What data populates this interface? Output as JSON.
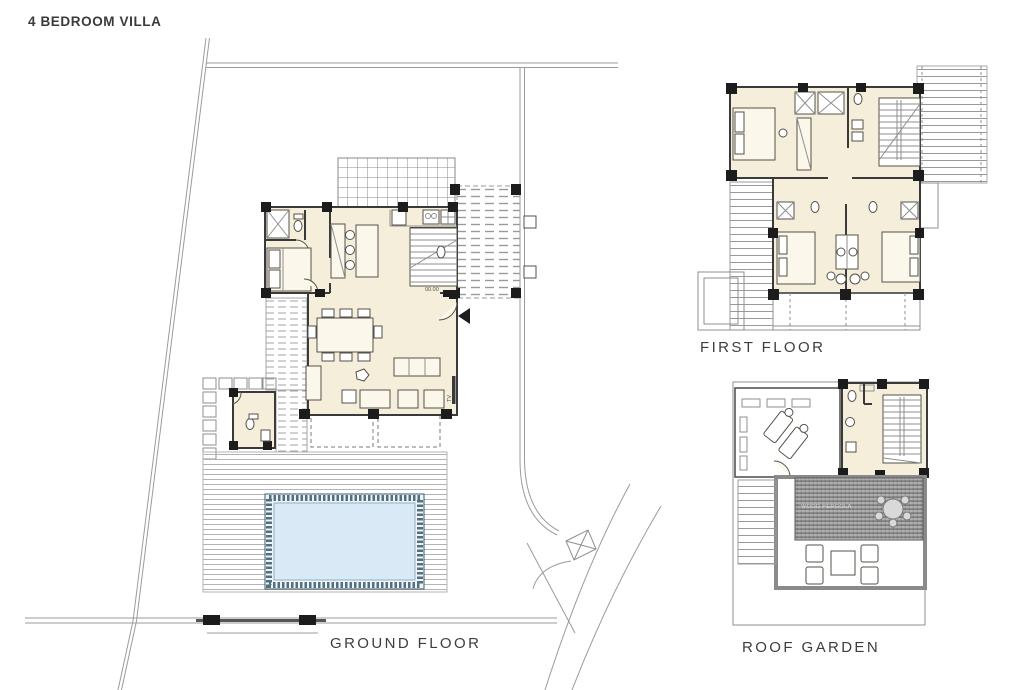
{
  "title": "4 BEDROOM VILLA",
  "plans": {
    "ground": {
      "label": "GROUND FLOOR",
      "annotations": {
        "level": "00.00",
        "tv": "TV"
      }
    },
    "first": {
      "label": "FIRST FLOOR"
    },
    "roof": {
      "label": "ROOF GARDEN",
      "pergola_label": "WOOD PERGOLA"
    }
  },
  "colors": {
    "cream": "#f5eedb",
    "pool-water": "#d9eaf6",
    "pool-band": "#54707f",
    "pergola-dark": "#9c9c9c",
    "line-dark": "#3a3a3a",
    "line-light": "#9b9b9b"
  }
}
